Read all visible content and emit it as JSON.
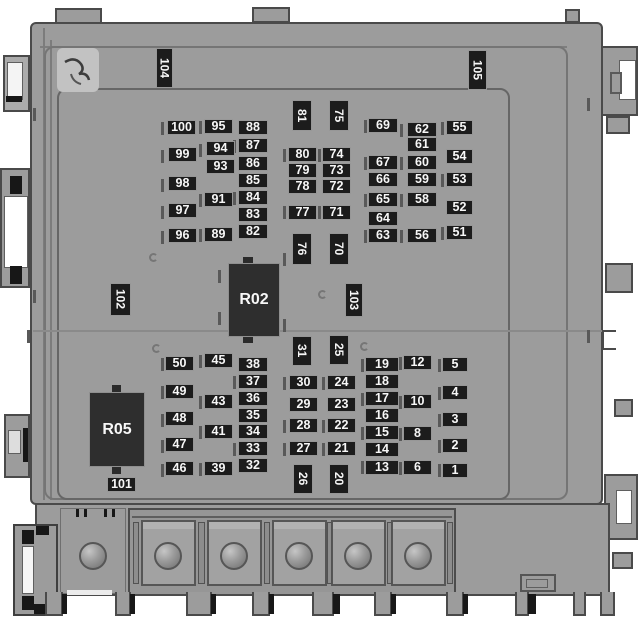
{
  "diagram": {
    "type": "vehicle-fuse-box-top-view",
    "colors": {
      "background": "#ffffff",
      "body": "#9c9c9c",
      "body_outline": "#4a4a4a",
      "label_bg": "#1c1c1c",
      "label_text": "#f7f7f7"
    },
    "relays": [
      {
        "id": "R02",
        "x": 228,
        "y": 263,
        "w": 52,
        "h": 74
      },
      {
        "id": "R05",
        "x": 89,
        "y": 392,
        "w": 56,
        "h": 75
      }
    ],
    "fuses_horizontal": [
      {
        "id": "100",
        "x": 167,
        "y": 120
      },
      {
        "id": "99",
        "x": 168,
        "y": 147
      },
      {
        "id": "98",
        "x": 168,
        "y": 176
      },
      {
        "id": "97",
        "x": 168,
        "y": 203
      },
      {
        "id": "96",
        "x": 168,
        "y": 228
      },
      {
        "id": "95",
        "x": 204,
        "y": 119
      },
      {
        "id": "94",
        "x": 206,
        "y": 141
      },
      {
        "id": "93",
        "x": 206,
        "y": 159
      },
      {
        "id": "91",
        "x": 204,
        "y": 192
      },
      {
        "id": "89",
        "x": 204,
        "y": 227
      },
      {
        "id": "88",
        "x": 238,
        "y": 120,
        "w": 30
      },
      {
        "id": "87",
        "x": 238,
        "y": 138,
        "w": 30
      },
      {
        "id": "86",
        "x": 238,
        "y": 156,
        "w": 30
      },
      {
        "id": "85",
        "x": 238,
        "y": 173,
        "w": 30
      },
      {
        "id": "84",
        "x": 238,
        "y": 190,
        "w": 30
      },
      {
        "id": "83",
        "x": 238,
        "y": 207,
        "w": 30
      },
      {
        "id": "82",
        "x": 238,
        "y": 224,
        "w": 30
      },
      {
        "id": "80",
        "x": 288,
        "y": 147
      },
      {
        "id": "79",
        "x": 288,
        "y": 163
      },
      {
        "id": "78",
        "x": 288,
        "y": 179
      },
      {
        "id": "77",
        "x": 288,
        "y": 205
      },
      {
        "id": "74",
        "x": 322,
        "y": 147
      },
      {
        "id": "73",
        "x": 322,
        "y": 163
      },
      {
        "id": "72",
        "x": 322,
        "y": 179
      },
      {
        "id": "71",
        "x": 322,
        "y": 205
      },
      {
        "id": "69",
        "x": 368,
        "y": 118,
        "w": 30
      },
      {
        "id": "67",
        "x": 368,
        "y": 155,
        "w": 30
      },
      {
        "id": "66",
        "x": 368,
        "y": 172,
        "w": 30
      },
      {
        "id": "65",
        "x": 368,
        "y": 192,
        "w": 30
      },
      {
        "id": "64",
        "x": 368,
        "y": 211,
        "w": 30
      },
      {
        "id": "63",
        "x": 368,
        "y": 228,
        "w": 30
      },
      {
        "id": "62",
        "x": 407,
        "y": 122,
        "w": 30
      },
      {
        "id": "61",
        "x": 407,
        "y": 137,
        "w": 30
      },
      {
        "id": "60",
        "x": 407,
        "y": 155,
        "w": 30
      },
      {
        "id": "59",
        "x": 407,
        "y": 172,
        "w": 30
      },
      {
        "id": "58",
        "x": 407,
        "y": 192,
        "w": 30
      },
      {
        "id": "56",
        "x": 407,
        "y": 228,
        "w": 30
      },
      {
        "id": "55",
        "x": 446,
        "y": 120,
        "w": 27
      },
      {
        "id": "54",
        "x": 446,
        "y": 149,
        "w": 27
      },
      {
        "id": "53",
        "x": 446,
        "y": 172,
        "w": 27
      },
      {
        "id": "52",
        "x": 446,
        "y": 200,
        "w": 27
      },
      {
        "id": "51",
        "x": 446,
        "y": 225,
        "w": 27
      },
      {
        "id": "50",
        "x": 165,
        "y": 356
      },
      {
        "id": "49",
        "x": 165,
        "y": 384
      },
      {
        "id": "48",
        "x": 165,
        "y": 411
      },
      {
        "id": "47",
        "x": 165,
        "y": 437
      },
      {
        "id": "46",
        "x": 165,
        "y": 461
      },
      {
        "id": "45",
        "x": 204,
        "y": 353
      },
      {
        "id": "43",
        "x": 204,
        "y": 394
      },
      {
        "id": "41",
        "x": 204,
        "y": 424
      },
      {
        "id": "39",
        "x": 204,
        "y": 461
      },
      {
        "id": "38",
        "x": 238,
        "y": 357,
        "w": 30
      },
      {
        "id": "37",
        "x": 238,
        "y": 374,
        "w": 30
      },
      {
        "id": "36",
        "x": 238,
        "y": 391,
        "w": 30
      },
      {
        "id": "35",
        "x": 238,
        "y": 408,
        "w": 30
      },
      {
        "id": "34",
        "x": 238,
        "y": 424,
        "w": 30
      },
      {
        "id": "33",
        "x": 238,
        "y": 441,
        "w": 30
      },
      {
        "id": "32",
        "x": 238,
        "y": 458,
        "w": 30
      },
      {
        "id": "101",
        "x": 107,
        "y": 477
      },
      {
        "id": "30",
        "x": 289,
        "y": 375
      },
      {
        "id": "29",
        "x": 289,
        "y": 397
      },
      {
        "id": "28",
        "x": 289,
        "y": 418
      },
      {
        "id": "27",
        "x": 289,
        "y": 441
      },
      {
        "id": "24",
        "x": 327,
        "y": 375
      },
      {
        "id": "23",
        "x": 327,
        "y": 397
      },
      {
        "id": "22",
        "x": 327,
        "y": 418
      },
      {
        "id": "21",
        "x": 327,
        "y": 441
      },
      {
        "id": "19",
        "x": 365,
        "y": 357,
        "w": 34
      },
      {
        "id": "18",
        "x": 365,
        "y": 374,
        "w": 34
      },
      {
        "id": "17",
        "x": 365,
        "y": 391,
        "w": 34
      },
      {
        "id": "16",
        "x": 365,
        "y": 408,
        "w": 34
      },
      {
        "id": "15",
        "x": 365,
        "y": 425,
        "w": 34
      },
      {
        "id": "14",
        "x": 365,
        "y": 442,
        "w": 34
      },
      {
        "id": "13",
        "x": 365,
        "y": 460,
        "w": 34
      },
      {
        "id": "12",
        "x": 403,
        "y": 355
      },
      {
        "id": "10",
        "x": 403,
        "y": 394
      },
      {
        "id": "8",
        "x": 403,
        "y": 426
      },
      {
        "id": "6",
        "x": 403,
        "y": 460
      },
      {
        "id": "5",
        "x": 442,
        "y": 357,
        "w": 26
      },
      {
        "id": "4",
        "x": 442,
        "y": 385,
        "w": 26
      },
      {
        "id": "3",
        "x": 442,
        "y": 412,
        "w": 26
      },
      {
        "id": "2",
        "x": 442,
        "y": 438,
        "w": 26
      },
      {
        "id": "1",
        "x": 442,
        "y": 463,
        "w": 26
      }
    ],
    "fuses_vertical": [
      {
        "id": "104",
        "x": 156,
        "y": 48,
        "w": 17,
        "h": 40
      },
      {
        "id": "105",
        "x": 468,
        "y": 50,
        "w": 19,
        "h": 40
      },
      {
        "id": "81",
        "x": 292,
        "y": 100,
        "h": 31
      },
      {
        "id": "75",
        "x": 329,
        "y": 100,
        "h": 31
      },
      {
        "id": "76",
        "x": 292,
        "y": 233
      },
      {
        "id": "70",
        "x": 329,
        "y": 233
      },
      {
        "id": "102",
        "x": 110,
        "y": 283,
        "w": 21,
        "h": 33
      },
      {
        "id": "103",
        "x": 345,
        "y": 283,
        "w": 18,
        "h": 34
      },
      {
        "id": "31",
        "x": 292,
        "y": 336,
        "h": 30
      },
      {
        "id": "25",
        "x": 329,
        "y": 335,
        "h": 30
      },
      {
        "id": "26",
        "x": 293,
        "y": 464,
        "h": 30
      },
      {
        "id": "20",
        "x": 329,
        "y": 464,
        "h": 30
      }
    ],
    "slot_ticks": [
      [
        161,
        122
      ],
      [
        161,
        150
      ],
      [
        161,
        179
      ],
      [
        161,
        206
      ],
      [
        161,
        231
      ],
      [
        199,
        121
      ],
      [
        199,
        144
      ],
      [
        199,
        194
      ],
      [
        199,
        229
      ],
      [
        233,
        140
      ],
      [
        233,
        192
      ],
      [
        283,
        149
      ],
      [
        283,
        206
      ],
      [
        318,
        149
      ],
      [
        318,
        206
      ],
      [
        364,
        120
      ],
      [
        364,
        157
      ],
      [
        364,
        194
      ],
      [
        364,
        230
      ],
      [
        400,
        124
      ],
      [
        400,
        157
      ],
      [
        400,
        194
      ],
      [
        400,
        230
      ],
      [
        441,
        122
      ],
      [
        441,
        174
      ],
      [
        441,
        227
      ],
      [
        218,
        270
      ],
      [
        218,
        312
      ],
      [
        283,
        253
      ],
      [
        283,
        319
      ],
      [
        161,
        358
      ],
      [
        161,
        386
      ],
      [
        161,
        414
      ],
      [
        161,
        440
      ],
      [
        161,
        464
      ],
      [
        199,
        355
      ],
      [
        199,
        396
      ],
      [
        199,
        426
      ],
      [
        199,
        463
      ],
      [
        233,
        376
      ],
      [
        233,
        443
      ],
      [
        283,
        377
      ],
      [
        283,
        420
      ],
      [
        283,
        443
      ],
      [
        322,
        377
      ],
      [
        322,
        420
      ],
      [
        322,
        443
      ],
      [
        361,
        359
      ],
      [
        361,
        393
      ],
      [
        361,
        427
      ],
      [
        361,
        461
      ],
      [
        399,
        357
      ],
      [
        399,
        396
      ],
      [
        399,
        428
      ],
      [
        399,
        462
      ],
      [
        438,
        359
      ],
      [
        438,
        387
      ],
      [
        438,
        414
      ],
      [
        438,
        440
      ],
      [
        438,
        464
      ],
      [
        587,
        98
      ],
      [
        587,
        330
      ],
      [
        33,
        108
      ],
      [
        33,
        290
      ],
      [
        27,
        330
      ]
    ],
    "curve_marks": [
      [
        149,
        253
      ],
      [
        152,
        344
      ],
      [
        318,
        290
      ],
      [
        360,
        342
      ]
    ],
    "mounting_holes": [
      [
        93,
        556
      ],
      [
        168,
        556
      ],
      [
        234,
        556
      ],
      [
        299,
        556
      ],
      [
        358,
        556
      ],
      [
        418,
        556
      ]
    ],
    "base_feet": [
      [
        45,
        18
      ],
      [
        115,
        16
      ],
      [
        186,
        26
      ],
      [
        252,
        18
      ],
      [
        312,
        22
      ],
      [
        374,
        18
      ],
      [
        446,
        18
      ],
      [
        515,
        14
      ],
      [
        573,
        13
      ],
      [
        600,
        15
      ]
    ],
    "feet_shadows": [
      [
        62,
        5
      ],
      [
        130,
        5
      ],
      [
        211,
        5
      ],
      [
        269,
        5
      ],
      [
        333,
        7
      ],
      [
        391,
        5
      ],
      [
        463,
        5
      ],
      [
        528,
        8
      ]
    ]
  }
}
